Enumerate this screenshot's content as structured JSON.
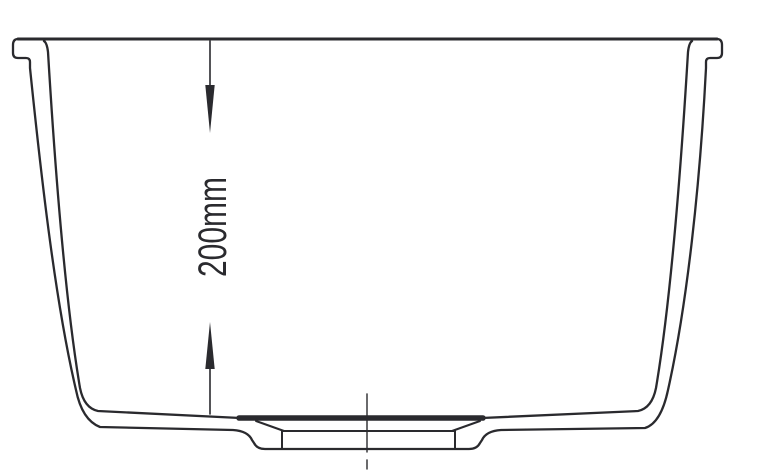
{
  "drawing": {
    "dimension": {
      "label": "200mm",
      "top_arrow_icon": "dimension-arrow-down",
      "bottom_arrow_icon": "dimension-arrow-up"
    },
    "colors": {
      "line": "#2a2a2e",
      "background": "#ffffff"
    }
  }
}
